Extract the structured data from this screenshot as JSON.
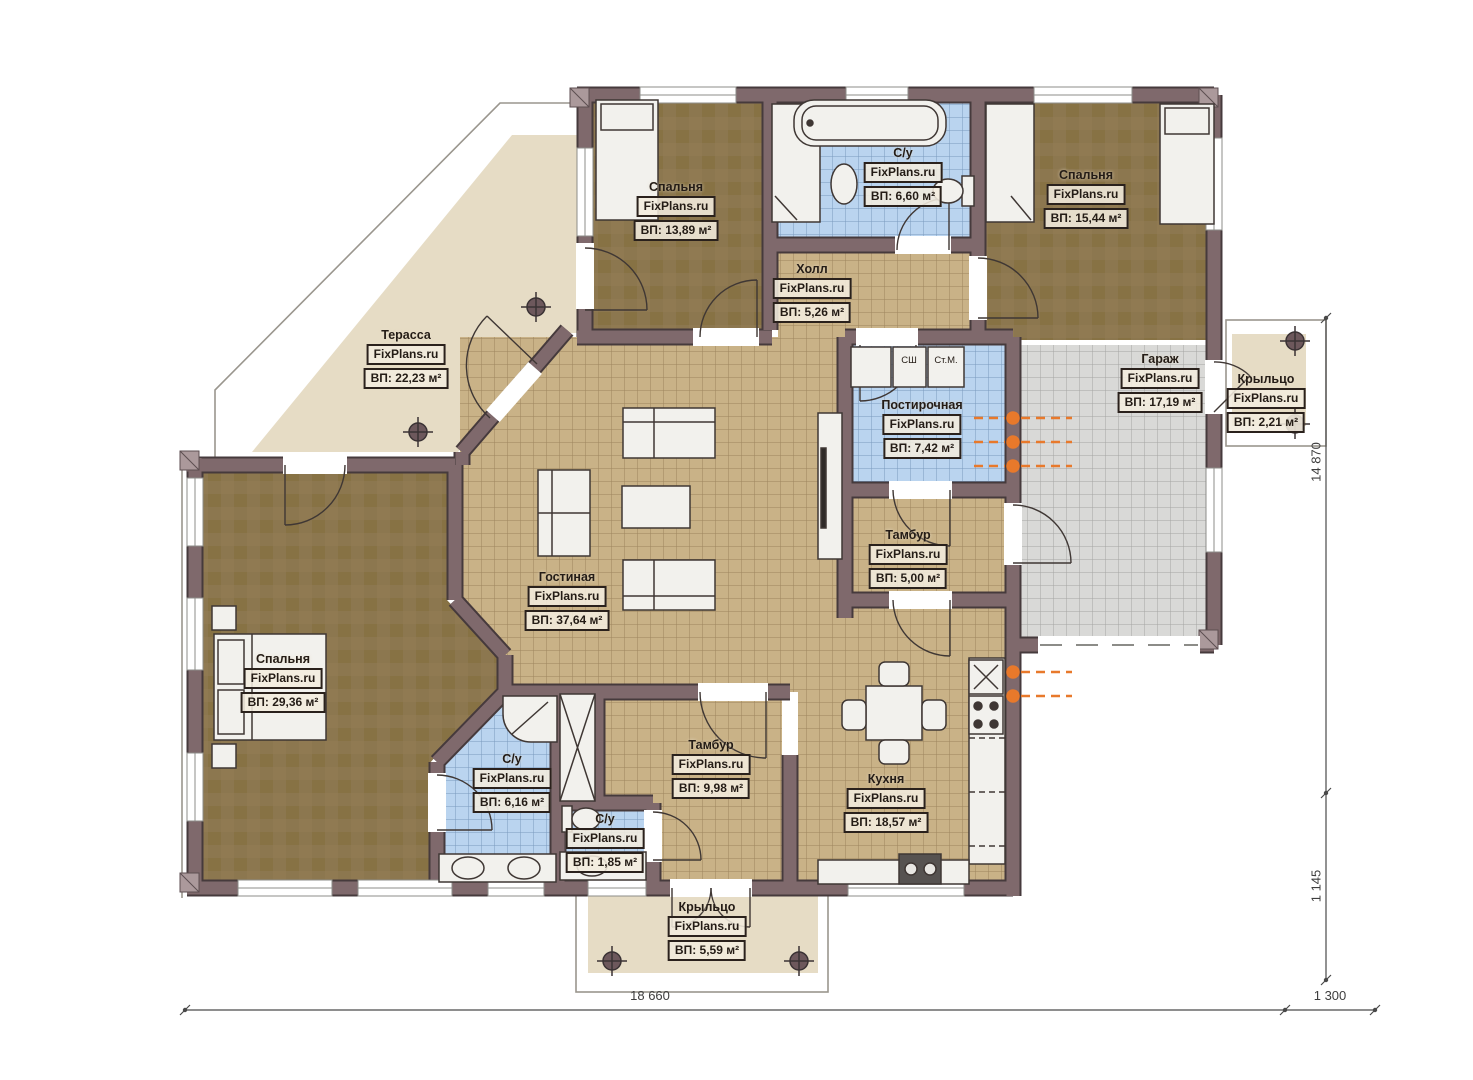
{
  "brand": "FixPlans.ru",
  "rooms": [
    {
      "id": "bedroom-top-left",
      "name": "Спальня",
      "area": "ВП: 13,89 м²"
    },
    {
      "id": "bath-top",
      "name": "С/у",
      "area": "ВП: 6,60 м²"
    },
    {
      "id": "bedroom-top-right",
      "name": "Спальня",
      "area": "ВП: 15,44 м²"
    },
    {
      "id": "hall",
      "name": "Холл",
      "area": "ВП: 5,26 м²"
    },
    {
      "id": "terrace",
      "name": "Терасса",
      "area": "ВП: 22,23 м²"
    },
    {
      "id": "garage",
      "name": "Гараж",
      "area": "ВП: 17,19 м²"
    },
    {
      "id": "porch-right",
      "name": "Крыльцо",
      "area": "ВП: 2,21 м²"
    },
    {
      "id": "laundry",
      "name": "Постирочная",
      "area": "ВП: 7,42 м²"
    },
    {
      "id": "tambour-upper",
      "name": "Тамбур",
      "area": "ВП: 5,00 м²"
    },
    {
      "id": "living-room",
      "name": "Гостиная",
      "area": "ВП: 37,64 м²"
    },
    {
      "id": "bedroom-left",
      "name": "Спальня",
      "area": "ВП: 29,36 м²"
    },
    {
      "id": "bath-left",
      "name": "С/у",
      "area": "ВП: 6,16 м²"
    },
    {
      "id": "bath-small",
      "name": "С/у",
      "area": "ВП: 1,85 м²"
    },
    {
      "id": "tambour-lower",
      "name": "Тамбур",
      "area": "ВП: 9,98 м²"
    },
    {
      "id": "kitchen",
      "name": "Кухня",
      "area": "ВП: 18,57 м²"
    },
    {
      "id": "porch-bottom",
      "name": "Крыльцо",
      "area": "ВП: 5,59 м²"
    }
  ],
  "appliances": {
    "dryer_cabinet": "СШ",
    "washing_machine": "Ст.М."
  },
  "dimensions": {
    "bottom_main": "18 660",
    "bottom_right": "1 300",
    "right_main": "14 870",
    "right_bottom": "1 145"
  },
  "colors": {
    "wall": "#7f696c",
    "wall_edge": "#463a3c",
    "floor_tile": "#c9b287",
    "bath_tile": "#bad4ef",
    "bedroom_floor": "#8c774f",
    "terrace_floor": "#e6dcc5",
    "garage_floor": "#d9d9d7",
    "radiator": "#e8792b"
  }
}
